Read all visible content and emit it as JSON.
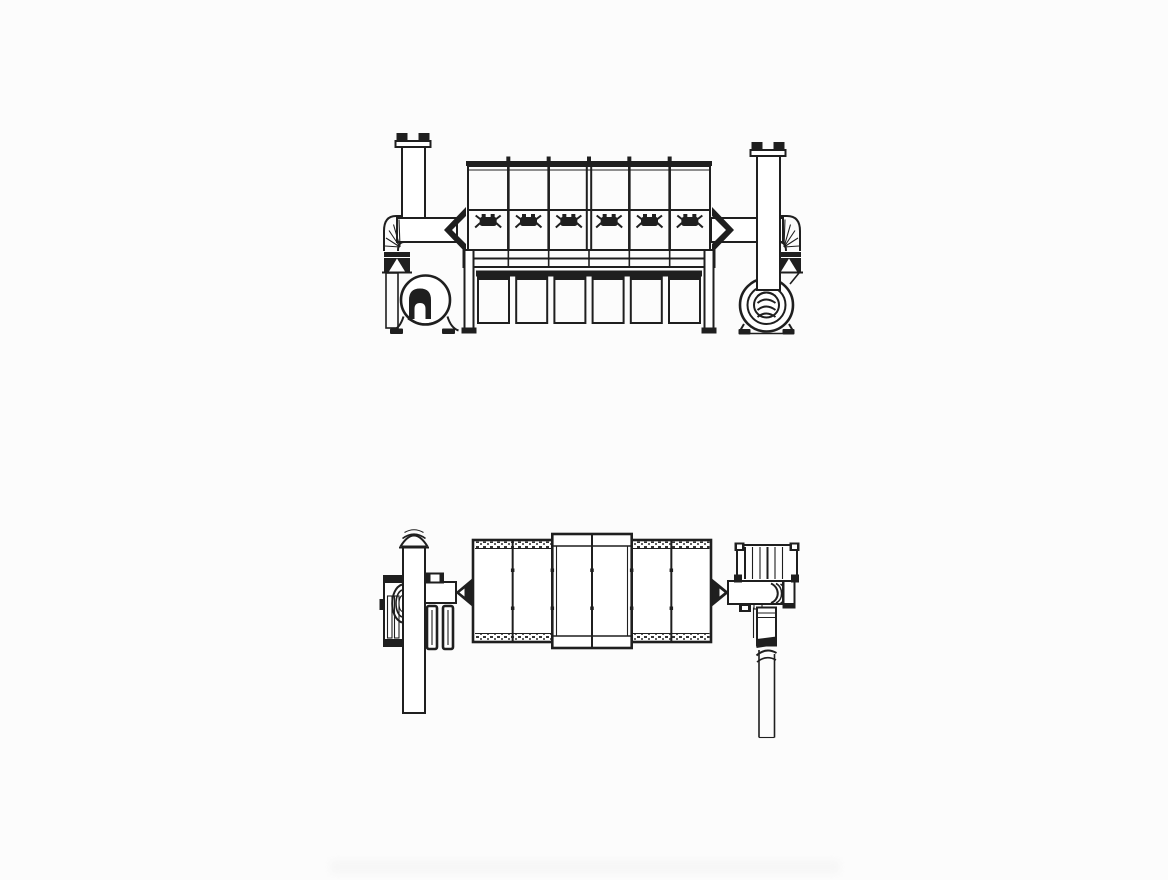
{
  "canvas": {
    "width": 1168,
    "height": 880,
    "background": "#fcfcfc",
    "line_color": "#1f1f1f"
  },
  "drawing": {
    "type": "technical-line-drawing",
    "views": [
      {
        "name": "front-elevation-view",
        "compartments": 6,
        "pulse_valves": 6,
        "hoppers": 6,
        "stacks": 2,
        "fans": 2,
        "ducts": 2
      },
      {
        "name": "plan-view",
        "compartments": 6,
        "pipes": 2,
        "ducts": 2,
        "fan_units": 2
      }
    ]
  }
}
